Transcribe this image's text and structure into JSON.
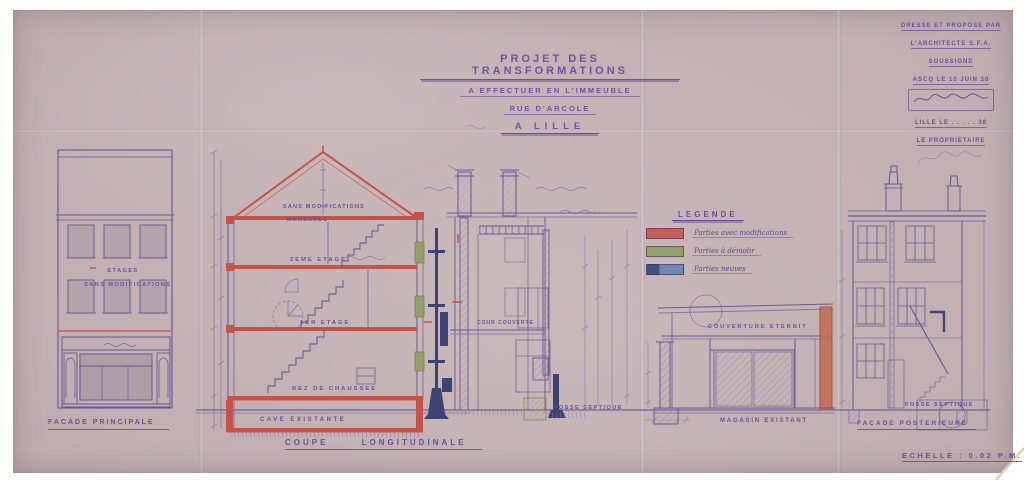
{
  "title_block": {
    "line1": "PROJET DES TRANSFORMATIONS",
    "line2": "A EFFECTUER EN L'IMMEUBLE",
    "line3": "RUE D'ARCOLE",
    "line4": "A LILLE"
  },
  "stamp_block": {
    "line1": "DRESSE ET PROPOSE PAR",
    "line2": "L'ARCHITECTE S.F.A.",
    "line3": "SOUSSIGNE",
    "date_line": "ASCQ LE 10 JUIN 38",
    "city_line": "LILLE LE . . . . . 38",
    "owner_line": "LE PROPRIETAIRE"
  },
  "legend": {
    "title": "LEGENDE",
    "items": [
      {
        "swatch_color": "#c4605a",
        "label": "Parties avec modifications"
      },
      {
        "swatch_color": "#93a06b",
        "label": "Parties à démolir"
      },
      {
        "swatch_color": "#44507e",
        "label": "Parties neuves"
      }
    ]
  },
  "left_elevation": {
    "wall_note_line1": "ETAGES",
    "wall_note_line2": "SANS MODIFICATIONS",
    "caption": "FACADE PRINCIPALE"
  },
  "section": {
    "attic_note_line1": "SANS MODIFICATIONS",
    "attic_note_line2": "MANSARDE",
    "floor2_label": "2EME ETAGE",
    "floor1_label": "1ER ETAGE",
    "ground_floor_label": "REZ DE CHAUSSEE",
    "basement_label": "CAVE EXISTANTE",
    "covered_yard_label": "COUR COUVERTE",
    "septic_tank_label": "FOSSE SEPTIQUE",
    "caption": "COUPE LONGITUDINALE"
  },
  "shed": {
    "roof_note": "COUVERTURE ETERNIT",
    "caption": "MAGASIN EXISTANT"
  },
  "rear_elevation": {
    "septic_tank_label": "FOSSE SEPTIQUE",
    "caption": "FACADE POSTERIEURE"
  },
  "scale_note": "ECHELLE : 0.02 P.M.",
  "colors": {
    "paper": "#c2b0b3",
    "ink": "#6a5694",
    "modified_red": "#c4605a",
    "demolish_green": "#93a06b",
    "new_navy": "#3d4474"
  }
}
